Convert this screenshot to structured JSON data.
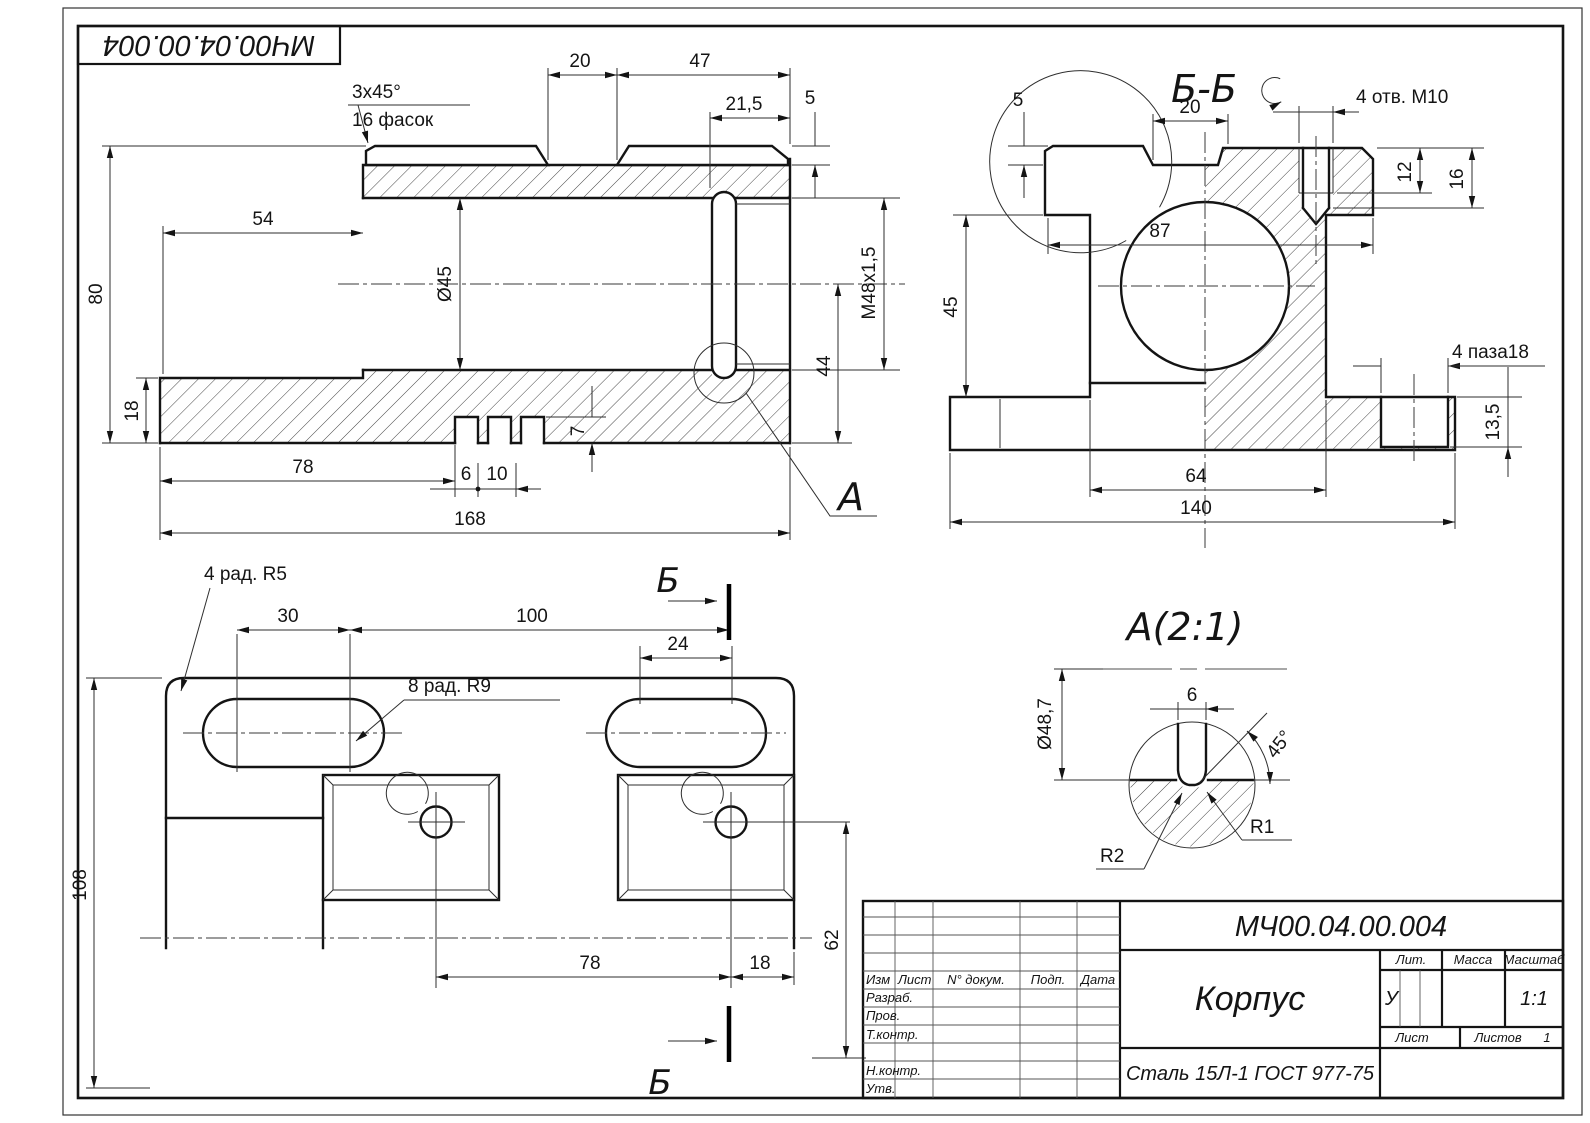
{
  "stamp": {
    "doc_number": "МЧ00.04.00.004"
  },
  "main_view": {
    "detail_label": "А",
    "dims": {
      "top_gap": "20",
      "top_right": "47",
      "pad_len": "21,5",
      "pad_h": "5",
      "chamfer": "3x45°",
      "chamfer_note": "16 фасок",
      "left_step": "54",
      "height": "80",
      "bore_dia": "Ø45",
      "base_h": "18",
      "slot_from_left": "78",
      "slot_w": "6",
      "slot_pitch": "10",
      "slot_depth": "7",
      "total_len": "168",
      "bore_axis_h": "44",
      "thread": "M48x1,5"
    }
  },
  "bb_view": {
    "title": "Б-Б",
    "dims": {
      "pad_h": "5",
      "top_gap": "20",
      "holes": "4 отв. М10",
      "thread_depth": "12",
      "hole_depth": "16",
      "body_w": "87",
      "step_h": "45",
      "slots": "4 паза18",
      "slot_depth": "13,5",
      "boss_w": "64",
      "base_w": "140"
    }
  },
  "plan_view": {
    "section_label": "Б",
    "dims": {
      "corner_r": "4 рад. R5",
      "slot_straight": "30",
      "slot_span": "100",
      "right_slot": "24",
      "slot_r": "8 рад. R9",
      "depth": "108",
      "hole_span": "78",
      "hole_edge": "18",
      "hole_offset": "62"
    }
  },
  "detail_view": {
    "title": "А(2:1)",
    "dims": {
      "dia": "Ø48,7",
      "groove_w": "6",
      "angle": "45°",
      "r1": "R1",
      "r2": "R2"
    }
  },
  "title_block": {
    "doc_number": "МЧ00.04.00.004",
    "part_name": "Корпус",
    "material": "Сталь 15Л-1  ГОСТ 977-75",
    "litera": "У",
    "scale": "1:1",
    "sheets": "1",
    "labels": {
      "izm": "Изм",
      "list": "Лист",
      "doc": "N° докум.",
      "podp": "Подп.",
      "date": "Дата",
      "razrab": "Разраб.",
      "prov": "Пров.",
      "tkontr": "Т.контр.",
      "nkontr": "Н.контр.",
      "utv": "Утв.",
      "lit": "Лит.",
      "massa": "Масса",
      "scale": "Масштаб",
      "list2": "Лист",
      "listov": "Листов"
    }
  }
}
